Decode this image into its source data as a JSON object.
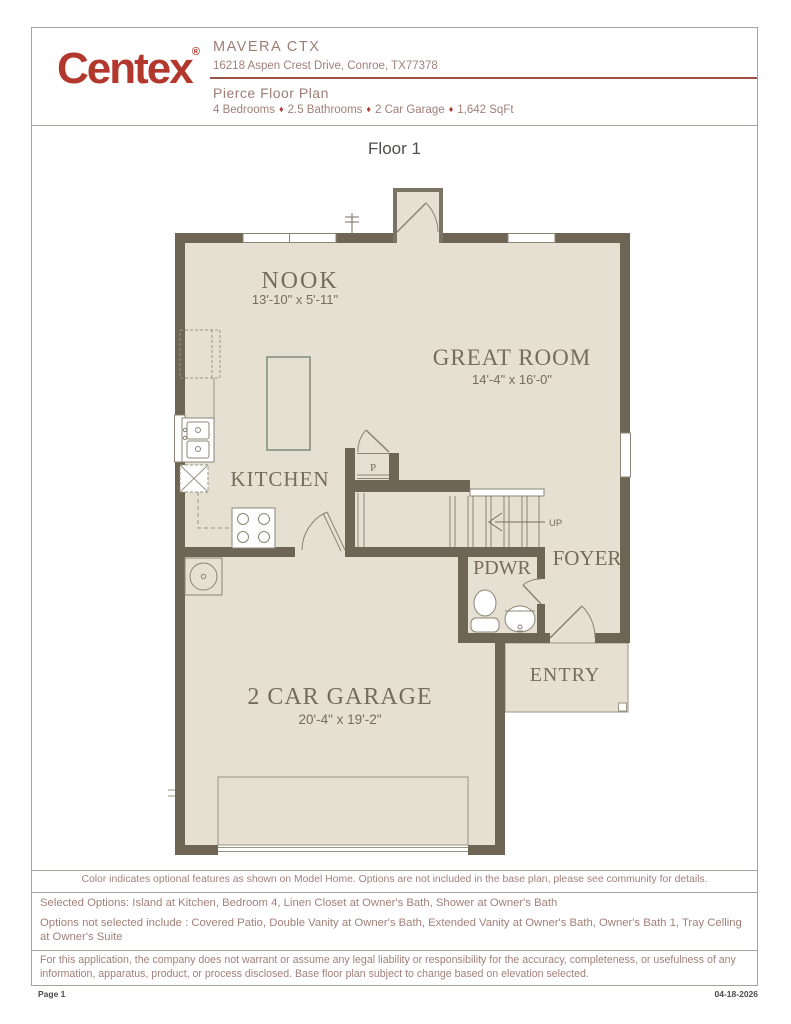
{
  "header": {
    "logo": "Centex",
    "logo_reg": "®",
    "community": "MAVERA CTX",
    "address": "16218 Aspen Crest Drive, Conroe, TX77378",
    "plan_title": "Pierce Floor Plan",
    "separator": "♦",
    "details": {
      "bedrooms": "4 Bedrooms",
      "bathrooms": "2.5 Bathrooms",
      "garage": "2 Car Garage",
      "sqft": "1,642 SqFt"
    }
  },
  "plan": {
    "floor_label": "Floor 1",
    "rooms": {
      "nook": {
        "name": "NOOK",
        "dims": "13'-10\" x 5'-11\""
      },
      "great_room": {
        "name": "GREAT ROOM",
        "dims": "14'-4\" x 16'-0\""
      },
      "kitchen": {
        "name": "KITCHEN"
      },
      "pantry": {
        "name": "P"
      },
      "stairs": {
        "label": "UP"
      },
      "pdwr": {
        "name": "PDWR"
      },
      "foyer": {
        "name": "FOYER"
      },
      "entry": {
        "name": "ENTRY"
      },
      "garage": {
        "name": "2 CAR GARAGE",
        "dims": "20'-4\" x 19'-2\""
      }
    }
  },
  "footer": {
    "note_color": "Color indicates optional features as shown on Model Home. Options are not included in the base plan, please see community for details.",
    "selected": "Selected Options: Island at Kitchen, Bedroom 4, Linen Closet at Owner's Bath, Shower at Owner's Bath",
    "not_selected": "Options not selected include : Covered Patio, Double Vanity at Owner's Bath, Extended Vanity at Owner's Bath, Owner's Bath 1, Tray Celling at Owner's Suite",
    "disclaimer": "For this application, the company does not warrant or assume any legal liability or responsibility for the accuracy, completeness, or usefulness of any information, apparatus, product, or process disclosed. Base floor plan subject to change based on elevation selected.",
    "page_label": "Page 1",
    "date": "04-18-2026"
  },
  "colors": {
    "logo_red": "#b2382e",
    "wall": "#6e6555",
    "floor": "#e5e0d2",
    "island_optional": "#7e8b79",
    "header_text": "#a28079"
  }
}
